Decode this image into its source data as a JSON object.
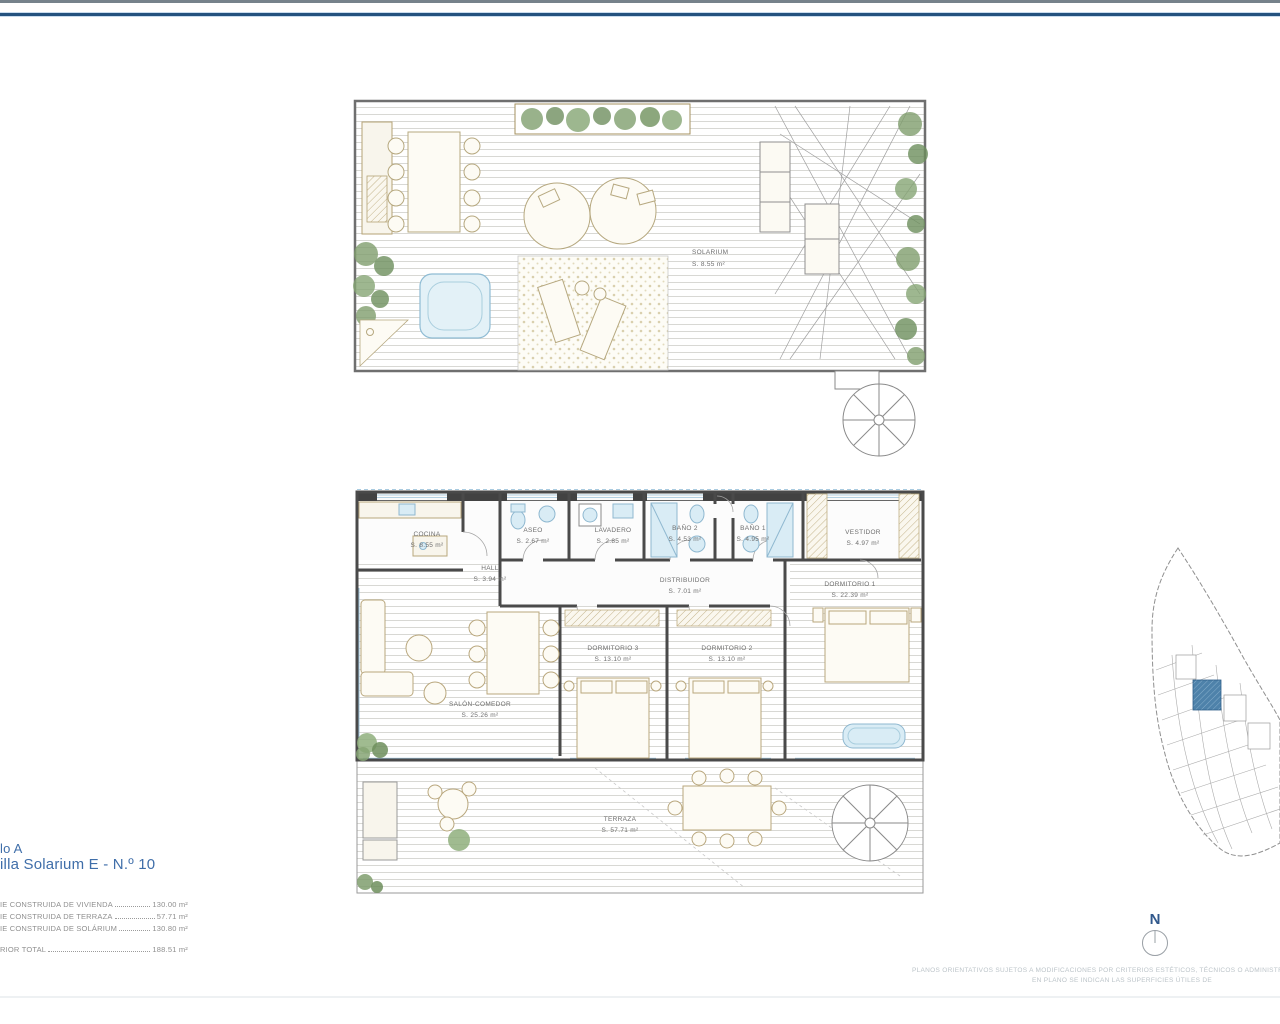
{
  "titles": {
    "line1": "lo A",
    "line2": "illa Solarium E - N.º 10"
  },
  "areas_table": {
    "rows": [
      {
        "label": "IE CONSTRUIDA DE VIVIENDA",
        "value": "130.00 m²"
      },
      {
        "label": "IE CONSTRUIDA DE TERRAZA",
        "value": "57.71 m²"
      },
      {
        "label": "IE CONSTRUIDA DE SOLÁRIUM",
        "value": "130.80 m²"
      }
    ],
    "total": {
      "label": "RIOR TOTAL",
      "value": "188.51 m²"
    }
  },
  "solarium_plan": {
    "room_label": "SOLARIUM",
    "room_area": "S. 8.55 m²"
  },
  "floor_plan": {
    "rooms": [
      {
        "name": "COCINA",
        "area": "S. 8.55 m²"
      },
      {
        "name": "HALL",
        "area": "S. 3.94 m²"
      },
      {
        "name": "ASEO",
        "area": "S. 2.67 m²"
      },
      {
        "name": "LAVADERO",
        "area": "S. 2.85 m²"
      },
      {
        "name": "BAÑO 2",
        "area": "S. 4.53 m²"
      },
      {
        "name": "BAÑO 1",
        "area": "S. 4.95 m²"
      },
      {
        "name": "VESTIDOR",
        "area": "S. 4.97 m²"
      },
      {
        "name": "DISTRIBUIDOR",
        "area": "S. 7.01 m²"
      },
      {
        "name": "DORMITORIO 1",
        "area": "S. 22.39 m²"
      },
      {
        "name": "DORMITORIO 3",
        "area": "S. 13.10 m²"
      },
      {
        "name": "DORMITORIO 2",
        "area": "S. 13.10 m²"
      },
      {
        "name": "SALÓN-COMEDOR",
        "area": "S. 25.26 m²"
      },
      {
        "name": "TERRAZA",
        "area": "S. 57.71 m²"
      }
    ]
  },
  "site_plan": {
    "highlight_color": "#4e82aa"
  },
  "compass": {
    "north_label": "N"
  },
  "disclaimer": {
    "line1": "PLANOS ORIENTATIVOS SUJETOS A MODIFICACIONES POR CRITERIOS ESTÉTICOS, TÉCNICOS O ADMINISTRATIVOS. A",
    "line2": "EN PLANO SE INDICAN LAS SUPERFICIES ÚTILES DE"
  },
  "colors": {
    "title_blue": "#3f6ea9",
    "rule_blue": "#24527f",
    "parcel_highlight": "#4e82aa"
  }
}
